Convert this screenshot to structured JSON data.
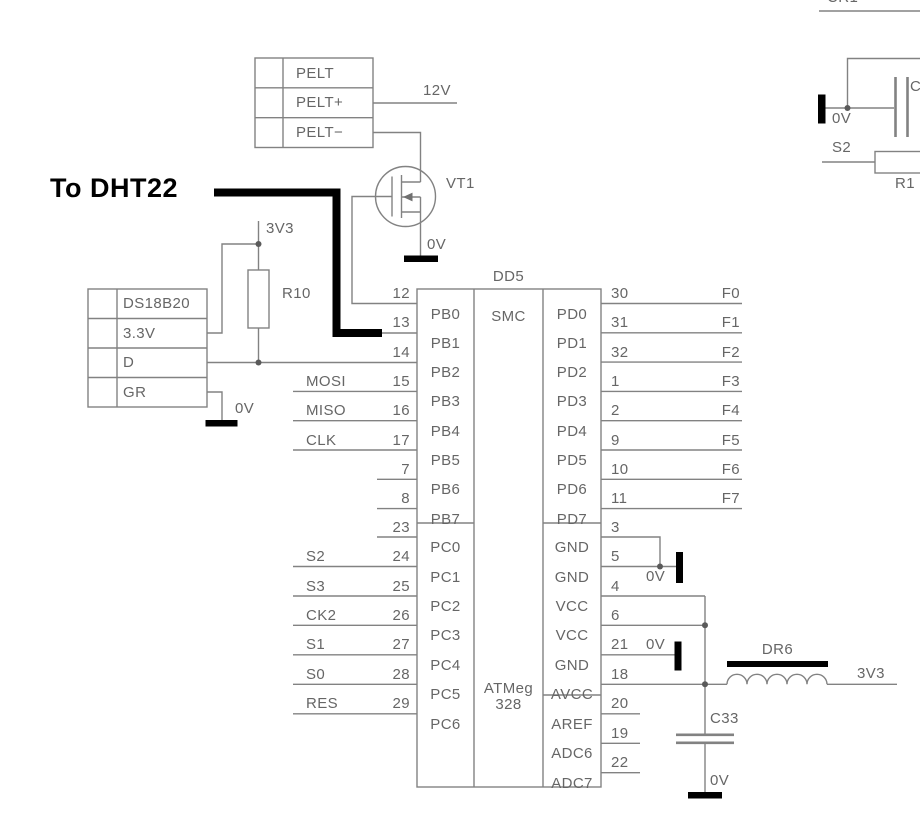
{
  "annotations": {
    "to_dht22": "To DHT22"
  },
  "ic": {
    "ref": "DD5",
    "part_top": "SMC",
    "part_bottom_1": "ATMeg",
    "part_bottom_2": "328",
    "left_pins": [
      {
        "num": "12",
        "name": "PB0",
        "signal": ""
      },
      {
        "num": "13",
        "name": "PB1",
        "signal": ""
      },
      {
        "num": "14",
        "name": "PB2",
        "signal": ""
      },
      {
        "num": "15",
        "name": "PB3",
        "signal": "MOSI"
      },
      {
        "num": "16",
        "name": "PB4",
        "signal": "MISO"
      },
      {
        "num": "17",
        "name": "PB5",
        "signal": "CLK"
      },
      {
        "num": "7",
        "name": "PB6",
        "signal": ""
      },
      {
        "num": "8",
        "name": "PB7",
        "signal": ""
      },
      {
        "num": "23",
        "name": "PC0",
        "signal": ""
      },
      {
        "num": "24",
        "name": "PC1",
        "signal": "S2"
      },
      {
        "num": "25",
        "name": "PC2",
        "signal": "S3"
      },
      {
        "num": "26",
        "name": "PC3",
        "signal": "CK2"
      },
      {
        "num": "27",
        "name": "PC4",
        "signal": "S1"
      },
      {
        "num": "28",
        "name": "PC5",
        "signal": "S0"
      },
      {
        "num": "29",
        "name": "PC6",
        "signal": "RES"
      }
    ],
    "right_pins": [
      {
        "num": "30",
        "name": "PD0",
        "signal": "F0"
      },
      {
        "num": "31",
        "name": "PD1",
        "signal": "F1"
      },
      {
        "num": "32",
        "name": "PD2",
        "signal": "F2"
      },
      {
        "num": "1",
        "name": "PD3",
        "signal": "F3"
      },
      {
        "num": "2",
        "name": "PD4",
        "signal": "F4"
      },
      {
        "num": "9",
        "name": "PD5",
        "signal": "F5"
      },
      {
        "num": "10",
        "name": "PD6",
        "signal": "F6"
      },
      {
        "num": "11",
        "name": "PD7",
        "signal": "F7"
      },
      {
        "num": "3",
        "name": "GND",
        "signal": ""
      },
      {
        "num": "5",
        "name": "GND",
        "signal": ""
      },
      {
        "num": "4",
        "name": "VCC",
        "signal": ""
      },
      {
        "num": "6",
        "name": "VCC",
        "signal": ""
      },
      {
        "num": "21",
        "name": "GND",
        "signal": ""
      },
      {
        "num": "18",
        "name": "AVCC",
        "signal": ""
      },
      {
        "num": "20",
        "name": "AREF",
        "signal": ""
      },
      {
        "num": "19",
        "name": "ADC6",
        "signal": ""
      },
      {
        "num": "22",
        "name": "ADC7",
        "signal": ""
      }
    ]
  },
  "connectors": {
    "pelt": {
      "rows": [
        "PELT",
        "PELT+",
        "PELT−"
      ]
    },
    "ds18b20": {
      "rows": [
        "DS18B20",
        "3.3V",
        "D",
        "GR"
      ]
    }
  },
  "components": {
    "vt1": "VT1",
    "r10": "R10",
    "dr6": "DR6",
    "c33": "C33",
    "r1": "R1",
    "cr1": "CR1",
    "c_partial": "C"
  },
  "nets": {
    "v12": "12V",
    "v3v3": "3V3",
    "v0": "0V",
    "s2": "S2"
  },
  "colors": {
    "wire": "#828282",
    "text": "#666666",
    "ink": "#000000",
    "background": "#ffffff"
  }
}
